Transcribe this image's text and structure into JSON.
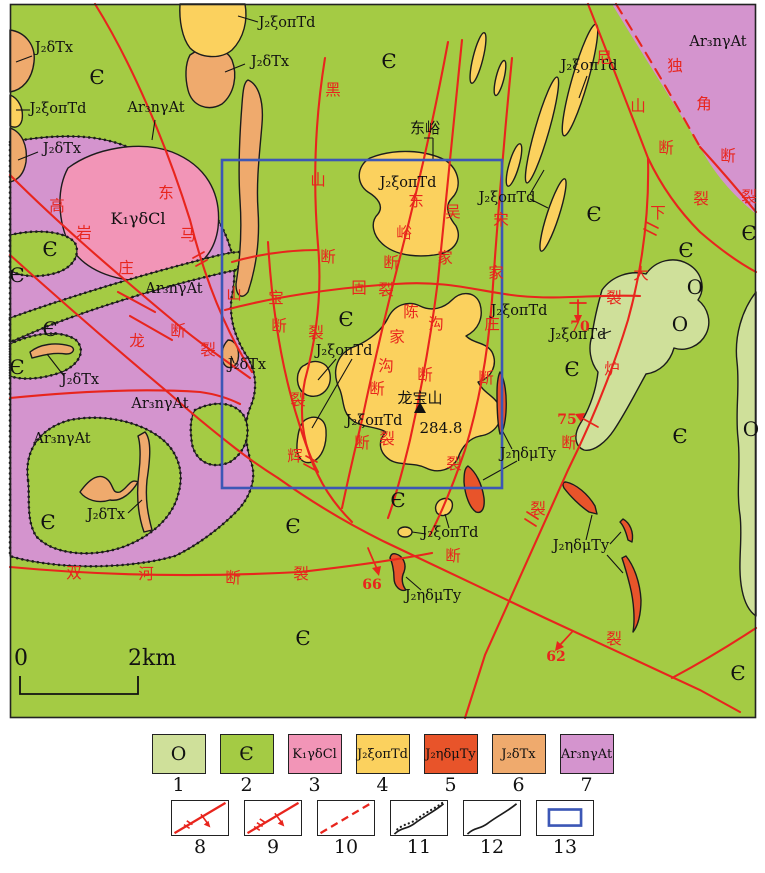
{
  "colors": {
    "ordovician": "#cfe09a",
    "cambrian": "#a4cb44",
    "cretaceous_granite": "#f295b7",
    "j2_xi": "#fbd15e",
    "j2_eta": "#e8542a",
    "j2_delta": "#efaa6d",
    "archean": "#d494ce",
    "fault_red": "#e8251d",
    "study_frame": "#3c57b6",
    "line_black": "#1c1c1c"
  },
  "map": {
    "unit_labels": [
      {
        "t": "J₂δTx",
        "x": 54,
        "y": 52
      },
      {
        "t": "Є",
        "x": 97,
        "y": 84,
        "cls": "big"
      },
      {
        "t": "J₂ξoπTd",
        "x": 58,
        "y": 113
      },
      {
        "t": "J₂δTx",
        "x": 62,
        "y": 153
      },
      {
        "t": "Ar₃nγAt",
        "x": 156,
        "y": 112
      },
      {
        "t": "K₁γδCl",
        "x": 138,
        "y": 224,
        "cls": "med"
      },
      {
        "t": "J₂ξoπTd",
        "x": 287,
        "y": 27
      },
      {
        "t": "J₂δTx",
        "x": 270,
        "y": 66
      },
      {
        "t": "Є",
        "x": 389,
        "y": 68,
        "cls": "big"
      },
      {
        "t": "J₂ξoπTd",
        "x": 408,
        "y": 187
      },
      {
        "t": "J₂ξoπTd",
        "x": 507,
        "y": 202
      },
      {
        "t": "J₂ξoπTd",
        "x": 589,
        "y": 70
      },
      {
        "t": "Ar₃nγAt",
        "x": 718,
        "y": 46
      },
      {
        "t": "Є",
        "x": 594,
        "y": 221,
        "cls": "big"
      },
      {
        "t": "Є",
        "x": 749,
        "y": 240,
        "cls": "big"
      },
      {
        "t": "Є",
        "x": 50,
        "y": 256,
        "cls": "big"
      },
      {
        "t": "Є",
        "x": 17,
        "y": 282,
        "cls": "big"
      },
      {
        "t": "Є",
        "x": 50,
        "y": 336,
        "cls": "big"
      },
      {
        "t": "Є",
        "x": 17,
        "y": 374,
        "cls": "big"
      },
      {
        "t": "Ar₃nγAt",
        "x": 174,
        "y": 293
      },
      {
        "t": "J₂δTx",
        "x": 80,
        "y": 384
      },
      {
        "t": "J₂δTx",
        "x": 247,
        "y": 369
      },
      {
        "t": "Ar₃nγAt",
        "x": 160,
        "y": 408
      },
      {
        "t": "Ar₃nγAt",
        "x": 62,
        "y": 443
      },
      {
        "t": "Є",
        "x": 346,
        "y": 326,
        "cls": "big"
      },
      {
        "t": "J₂ξoπTd",
        "x": 344,
        "y": 355
      },
      {
        "t": "J₂ξoπTd",
        "x": 374,
        "y": 425
      },
      {
        "t": "J₂ξoπTd",
        "x": 519,
        "y": 315
      },
      {
        "t": "J₂ξoπTd",
        "x": 578,
        "y": 339
      },
      {
        "t": "Є",
        "x": 572,
        "y": 376,
        "cls": "big"
      },
      {
        "t": "Є",
        "x": 686,
        "y": 257,
        "cls": "big"
      },
      {
        "t": "O",
        "x": 695,
        "y": 294,
        "cls": "big"
      },
      {
        "t": "O",
        "x": 680,
        "y": 331,
        "cls": "big"
      },
      {
        "t": "O",
        "x": 751,
        "y": 436,
        "cls": "big"
      },
      {
        "t": "Є",
        "x": 680,
        "y": 443,
        "cls": "big"
      },
      {
        "t": "J₂ηδμTy",
        "x": 528,
        "y": 458
      },
      {
        "t": "Є",
        "x": 48,
        "y": 529,
        "cls": "big"
      },
      {
        "t": "J₂δTx",
        "x": 106,
        "y": 519
      },
      {
        "t": "Є",
        "x": 293,
        "y": 533,
        "cls": "big"
      },
      {
        "t": "Є",
        "x": 398,
        "y": 507,
        "cls": "big"
      },
      {
        "t": "J₂ξoπTd",
        "x": 450,
        "y": 537
      },
      {
        "t": "J₂ηδμTy",
        "x": 433,
        "y": 600
      },
      {
        "t": "J₂ηδμTy",
        "x": 581,
        "y": 550
      },
      {
        "t": "Є",
        "x": 303,
        "y": 645,
        "cls": "big"
      },
      {
        "t": "Є",
        "x": 738,
        "y": 680,
        "cls": "big"
      },
      {
        "t": "东峪",
        "x": 425,
        "y": 133,
        "cls": "place"
      },
      {
        "t": "龙宝山",
        "x": 420,
        "y": 403,
        "cls": "place"
      },
      {
        "t": "284.8",
        "x": 441,
        "y": 433,
        "cls": "place"
      }
    ],
    "fault_chars": [
      {
        "t": "高",
        "x": 57,
        "y": 211
      },
      {
        "t": "岩",
        "x": 84,
        "y": 238
      },
      {
        "t": "庄",
        "x": 126,
        "y": 273
      },
      {
        "t": "东",
        "x": 166,
        "y": 198
      },
      {
        "t": "马",
        "x": 188,
        "y": 240
      },
      {
        "t": "山",
        "x": 234,
        "y": 299
      },
      {
        "t": "断",
        "x": 178,
        "y": 336
      },
      {
        "t": "裂",
        "x": 208,
        "y": 355
      },
      {
        "t": "龙",
        "x": 137,
        "y": 346
      },
      {
        "t": "黑",
        "x": 333,
        "y": 95
      },
      {
        "t": "山",
        "x": 318,
        "y": 185
      },
      {
        "t": "断",
        "x": 328,
        "y": 262
      },
      {
        "t": "裂",
        "x": 316,
        "y": 338
      },
      {
        "t": "固",
        "x": 359,
        "y": 293
      },
      {
        "t": "宝",
        "x": 276,
        "y": 303
      },
      {
        "t": "断",
        "x": 279,
        "y": 331
      },
      {
        "t": "裂",
        "x": 298,
        "y": 405
      },
      {
        "t": "辉",
        "x": 295,
        "y": 461
      },
      {
        "t": "东",
        "x": 416,
        "y": 206
      },
      {
        "t": "峪",
        "x": 404,
        "y": 238
      },
      {
        "t": "断",
        "x": 391,
        "y": 268
      },
      {
        "t": "裂",
        "x": 386,
        "y": 295
      },
      {
        "t": "陈",
        "x": 411,
        "y": 317
      },
      {
        "t": "家",
        "x": 397,
        "y": 342
      },
      {
        "t": "沟",
        "x": 386,
        "y": 371
      },
      {
        "t": "断",
        "x": 377,
        "y": 394
      },
      {
        "t": "断",
        "x": 362,
        "y": 448
      },
      {
        "t": "裂",
        "x": 387,
        "y": 444
      },
      {
        "t": "吴",
        "x": 453,
        "y": 217
      },
      {
        "t": "家",
        "x": 445,
        "y": 263
      },
      {
        "t": "沟",
        "x": 436,
        "y": 329
      },
      {
        "t": "断",
        "x": 425,
        "y": 380
      },
      {
        "t": "宋",
        "x": 501,
        "y": 225
      },
      {
        "t": "家",
        "x": 496,
        "y": 278
      },
      {
        "t": "庄",
        "x": 492,
        "y": 329
      },
      {
        "t": "断",
        "x": 486,
        "y": 383
      },
      {
        "t": "裂",
        "x": 454,
        "y": 469
      },
      {
        "t": "尼",
        "x": 604,
        "y": 63
      },
      {
        "t": "山",
        "x": 638,
        "y": 111
      },
      {
        "t": "断",
        "x": 666,
        "y": 153
      },
      {
        "t": "裂",
        "x": 701,
        "y": 204
      },
      {
        "t": "独",
        "x": 675,
        "y": 71
      },
      {
        "t": "角",
        "x": 704,
        "y": 109
      },
      {
        "t": "断",
        "x": 728,
        "y": 161
      },
      {
        "t": "裂",
        "x": 749,
        "y": 202
      },
      {
        "t": "下",
        "x": 658,
        "y": 218
      },
      {
        "t": "大",
        "x": 641,
        "y": 279
      },
      {
        "t": "裂",
        "x": 614,
        "y": 303
      },
      {
        "t": "炉",
        "x": 612,
        "y": 374
      },
      {
        "t": "断",
        "x": 569,
        "y": 448
      },
      {
        "t": "裂",
        "x": 538,
        "y": 514
      },
      {
        "t": "双",
        "x": 74,
        "y": 578
      },
      {
        "t": "河",
        "x": 146,
        "y": 579
      },
      {
        "t": "断",
        "x": 233,
        "y": 583
      },
      {
        "t": "裂",
        "x": 301,
        "y": 579
      },
      {
        "t": "断",
        "x": 453,
        "y": 561
      },
      {
        "t": "裂",
        "x": 614,
        "y": 644
      }
    ],
    "dip_numbers": [
      {
        "t": "70",
        "x": 580,
        "y": 331
      },
      {
        "t": "75",
        "x": 567,
        "y": 424
      },
      {
        "t": "66",
        "x": 372,
        "y": 589
      },
      {
        "t": "62",
        "x": 556,
        "y": 661
      }
    ],
    "scale": {
      "start": "0",
      "end": "2km"
    }
  },
  "legend": {
    "row1": [
      {
        "num": "1",
        "label": "O",
        "color": "#cfe09a"
      },
      {
        "num": "2",
        "label": "Є",
        "color": "#a4cb44"
      },
      {
        "num": "3",
        "label": "K₁γδCl",
        "color": "#f295b7"
      },
      {
        "num": "4",
        "label": "J₂ξoπTd",
        "color": "#fbd15e"
      },
      {
        "num": "5",
        "label": "J₂ηδμTy",
        "color": "#e8542a"
      },
      {
        "num": "6",
        "label": "J₂δTx",
        "color": "#efaa6d"
      },
      {
        "num": "7",
        "label": "Ar₃nγAt",
        "color": "#d494ce"
      }
    ],
    "row2": [
      {
        "num": "8",
        "symbol": "fault-with-dip-arrow"
      },
      {
        "num": "9",
        "symbol": "fault-with-double-ticks"
      },
      {
        "num": "10",
        "symbol": "inferred-fault"
      },
      {
        "num": "11",
        "symbol": "unconformity-boundary"
      },
      {
        "num": "12",
        "symbol": "geologic-boundary"
      },
      {
        "num": "13",
        "symbol": "study-area-frame"
      }
    ]
  }
}
